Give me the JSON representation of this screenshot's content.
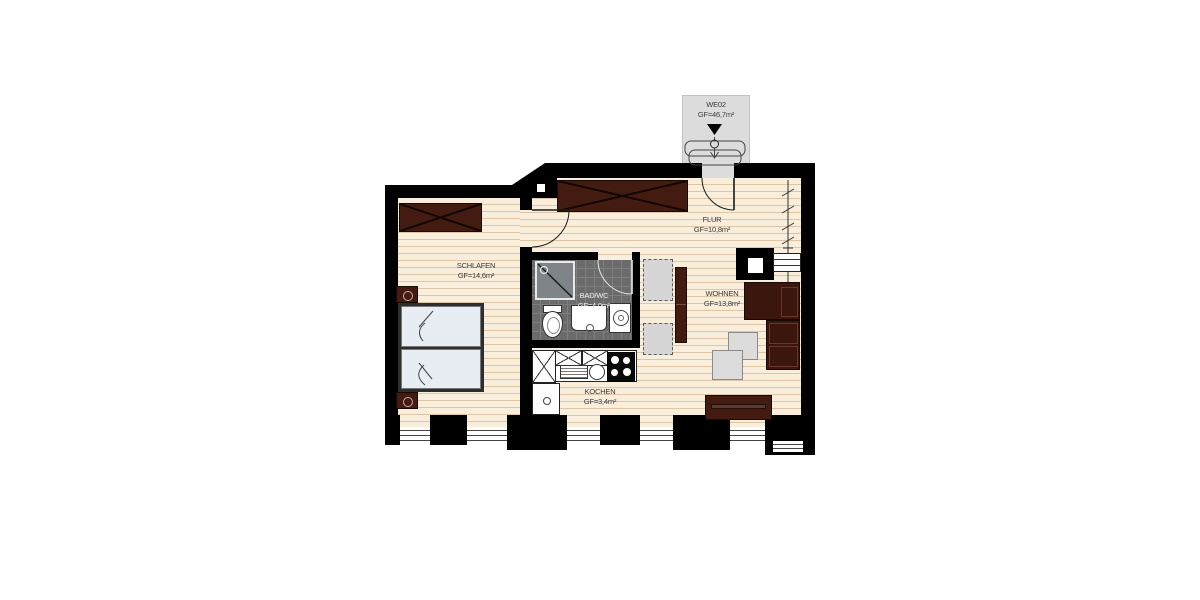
{
  "plan": {
    "unit": {
      "id": "WE02",
      "area": "GF=46,7m²"
    },
    "rooms": [
      {
        "key": "schlafen",
        "name": "SCHLAFEN",
        "area": "GF=14,6m²"
      },
      {
        "key": "flur",
        "name": "FLUR",
        "area": "GF=10,8m²"
      },
      {
        "key": "badwc",
        "name": "BAD/WC",
        "area": "GF=4,0m²"
      },
      {
        "key": "wohnen",
        "name": "WOHNEN",
        "area": "GF=13,8m²"
      },
      {
        "key": "kochen",
        "name": "KOCHEN",
        "area": "GF=3,4m²"
      }
    ],
    "colors": {
      "wall": "#000000",
      "floor": "#f8eedb",
      "plank_line": "#dcc6a6",
      "furniture_dark": "#431b10",
      "bath_tile": "#6b6b6b",
      "mattress": "#e8edf4",
      "landing": "#dcdcdc"
    },
    "symbols": {
      "entrance-arrow-icon": "black down-triangle",
      "door-closer-icon": "circle with plumb arrow",
      "door-swing-icon": "quarter-circle arc",
      "wardrobe-symbol": "dark box with X",
      "window-symbol": "triple glazing lines",
      "heating-riser-symbol": "line with diagonal ticks"
    }
  }
}
